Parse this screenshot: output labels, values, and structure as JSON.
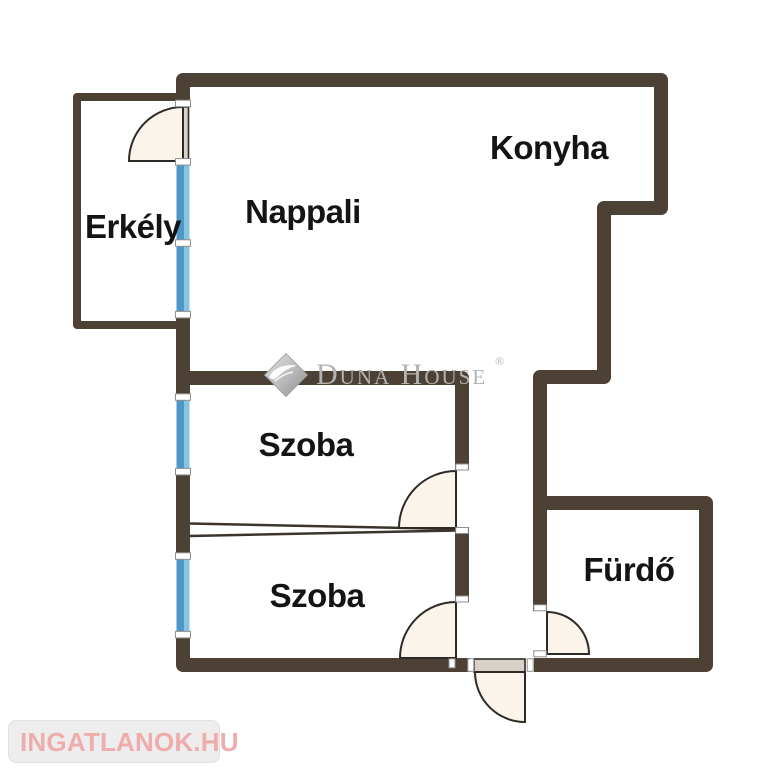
{
  "rooms": {
    "nappali": "Nappali",
    "konyha": "Konyha",
    "erkely": "Erkély",
    "szoba_felso": "Szoba",
    "szoba_also": "Szoba",
    "furdo": "Fürdő"
  },
  "watermark": {
    "brand": "Duna House",
    "registered_mark": "®"
  },
  "footer": {
    "logo_text": "INGATLANOK.HU"
  },
  "colors": {
    "wall": "#4d4136",
    "partition_line": "#3b342d",
    "window_blue": "#4f97c6",
    "window_blue_light": "#86c4e0",
    "door_fan_fill": "#fbf4ea",
    "door_leaf_fill": "#d9d2c8",
    "door_stroke": "#2e2a26",
    "watermark_gray": "#b3b3b3",
    "logo_text_pink": "#eeadac",
    "logo_icon_pink": "#f1a4a3",
    "logo_container_gray": "#ededed"
  }
}
